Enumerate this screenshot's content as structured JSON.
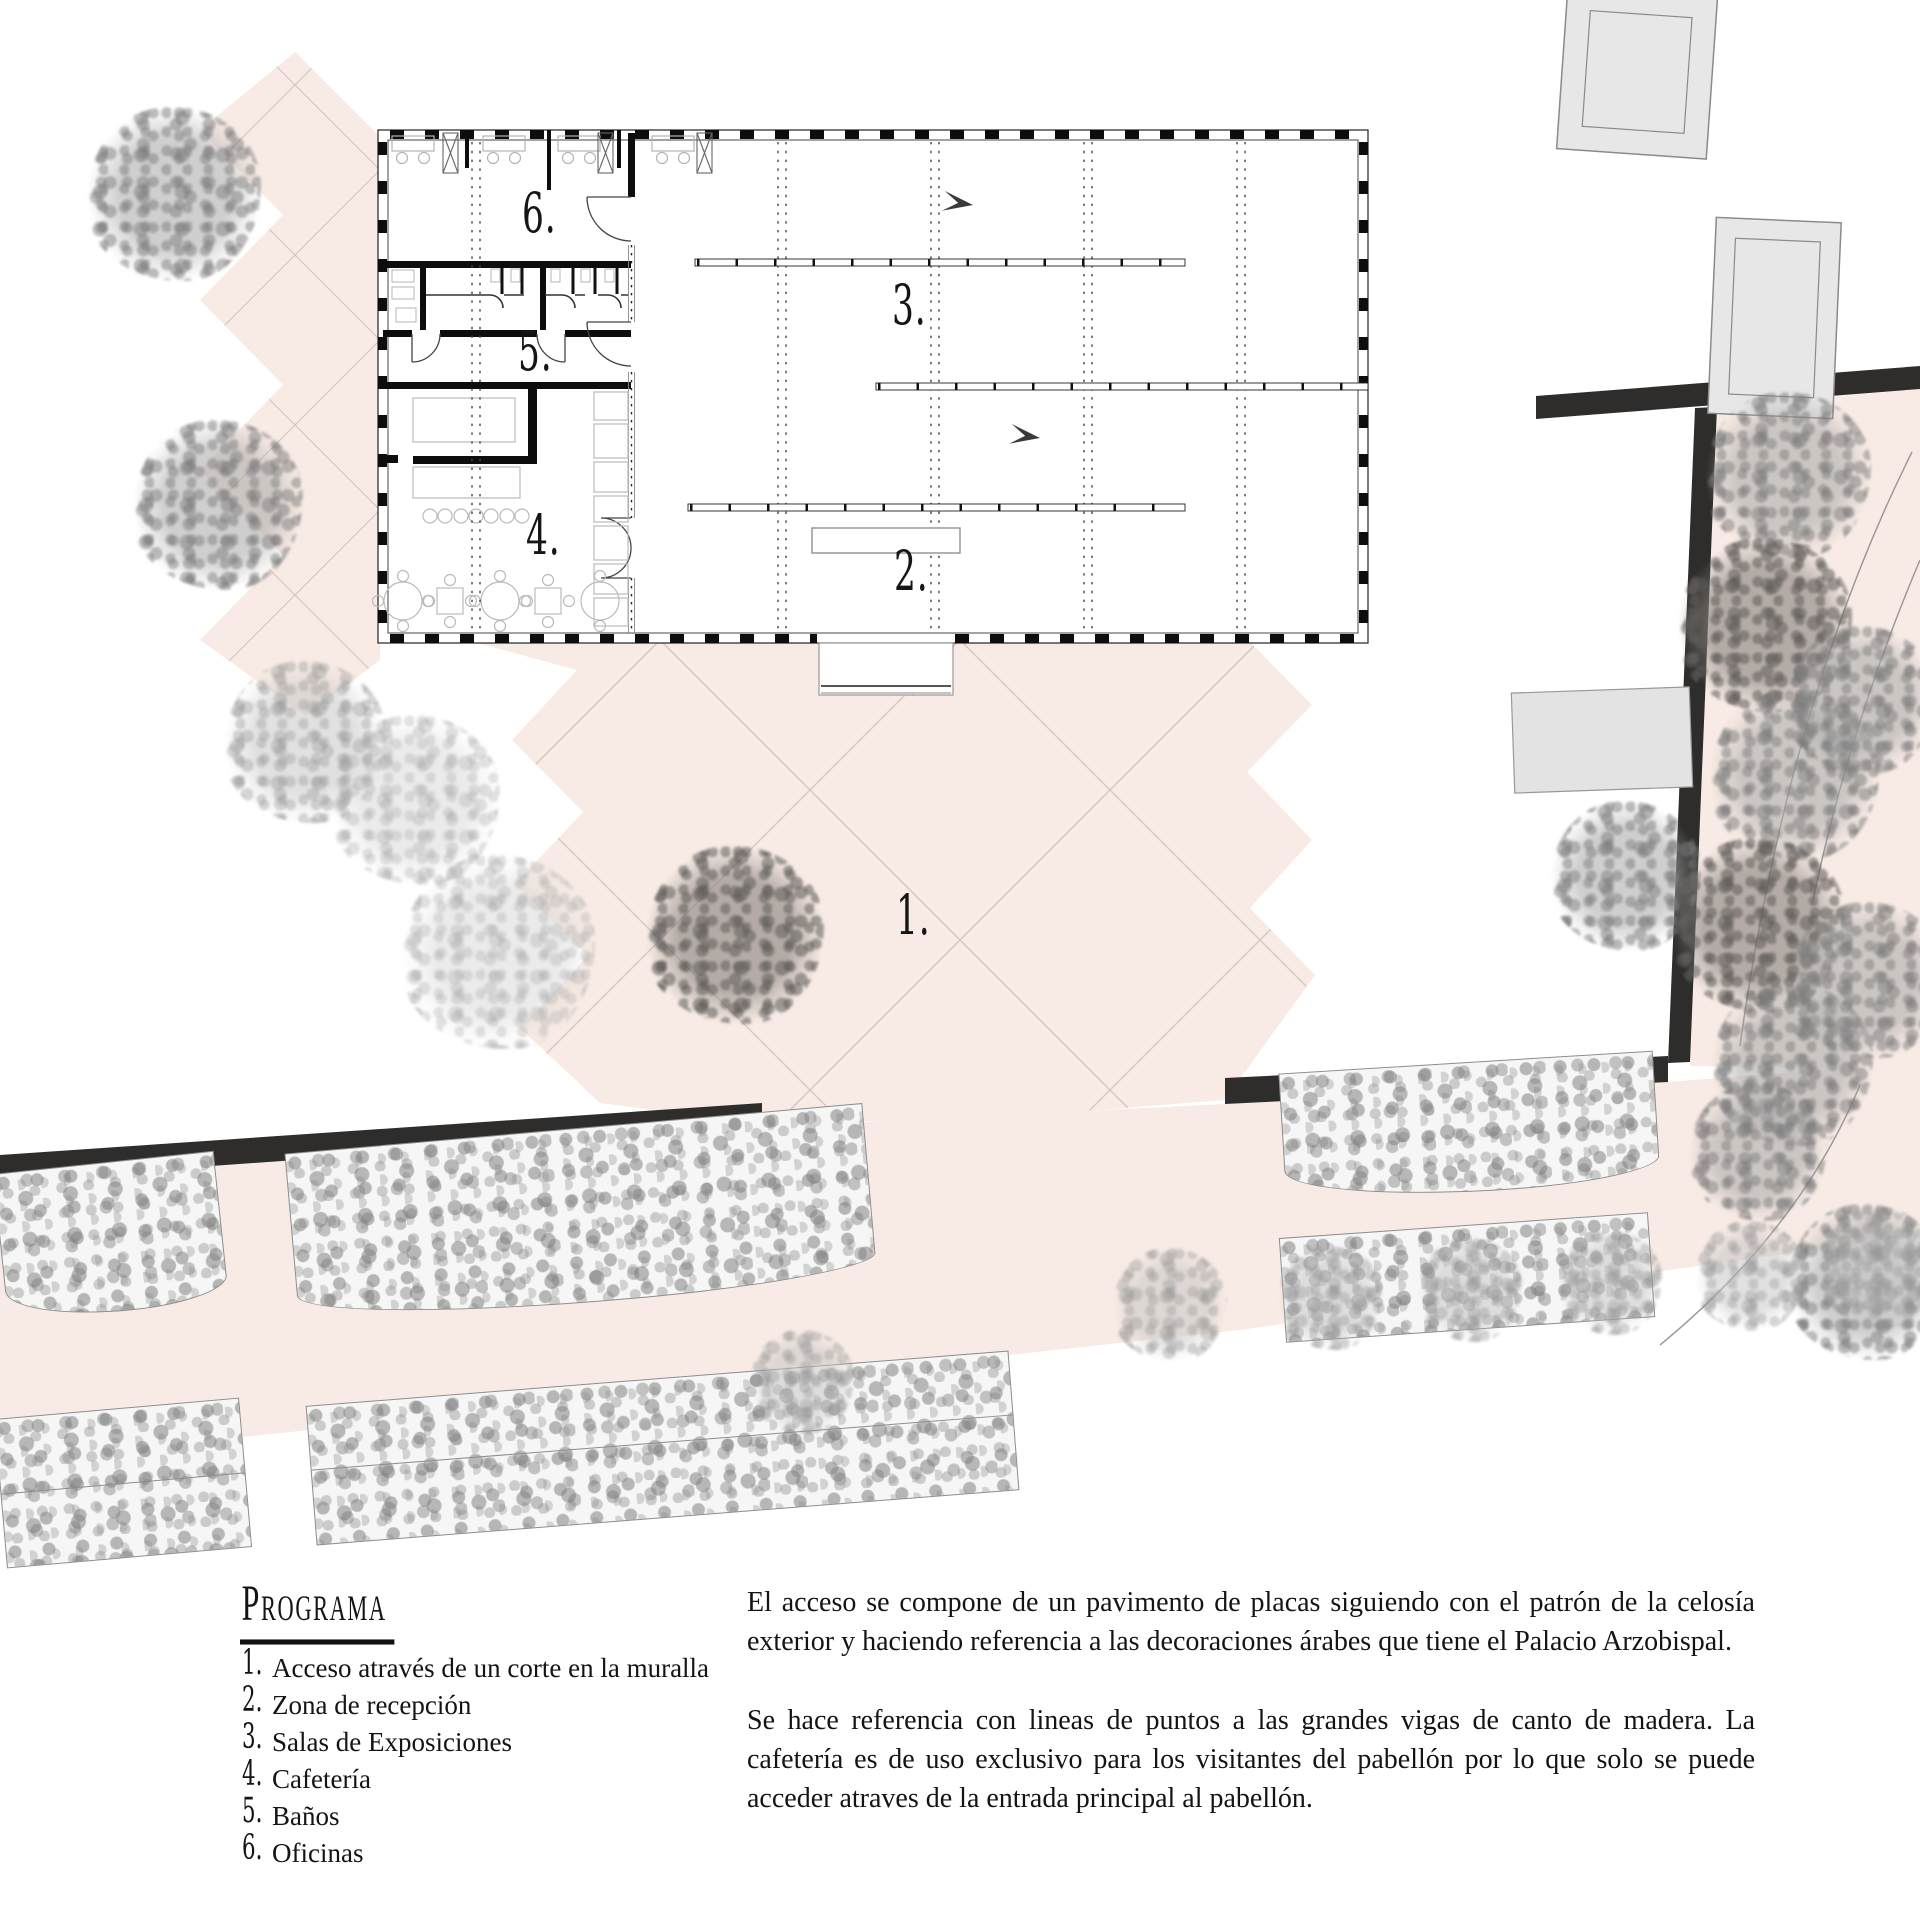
{
  "plan": {
    "labels": [
      {
        "zone": "access",
        "text": "1."
      },
      {
        "zone": "reception",
        "text": "2."
      },
      {
        "zone": "exhibition",
        "text": "3."
      },
      {
        "zone": "cafeteria",
        "text": "4."
      },
      {
        "zone": "banos",
        "text": "5."
      },
      {
        "zone": "oficinas",
        "text": "6."
      }
    ]
  },
  "programa": {
    "title": "Programa",
    "items": [
      {
        "num": "1.",
        "text": "Acceso através de un corte en la muralla"
      },
      {
        "num": "2.",
        "text": "Zona de recepción"
      },
      {
        "num": "3.",
        "text": "Salas de Exposiciones"
      },
      {
        "num": "4.",
        "text": "Cafetería"
      },
      {
        "num": "5.",
        "text": "Baños"
      },
      {
        "num": "6.",
        "text": "Oficinas"
      }
    ]
  },
  "description": {
    "p1": "El acceso se compone de un pavimento de placas siguiendo con el patrón de la celosía exterior y haciendo referencia a las decoraciones árabes que tiene el Palacio Arzobispal.",
    "p2": "Se hace referencia con lineas de puntos a las grandes vigas de canto de madera. La cafetería es de uso exclusivo para los visitantes del pabellón por lo que solo se puede acceder atraves de la entrada principal al pabellón."
  },
  "colors": {
    "paving_pink": "#f8ebe5",
    "grid_line": "#d8c7c0",
    "muralla_black": "#2e2d2c",
    "foliage_gray": "#9a9a9a",
    "concrete_gray": "#e7e7e7"
  }
}
